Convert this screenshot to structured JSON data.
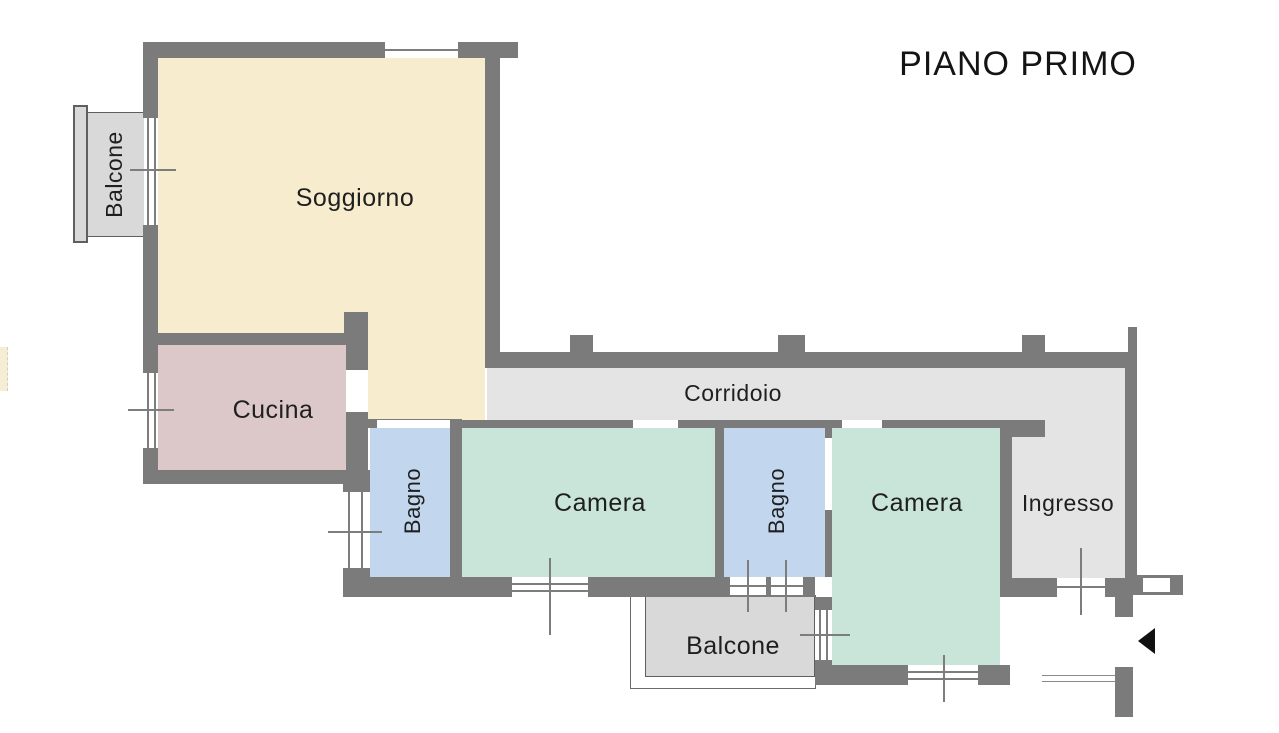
{
  "title": "PIANO PRIMO",
  "rooms": {
    "soggiorno": {
      "label": "Soggiorno"
    },
    "cucina": {
      "label": "Cucina"
    },
    "corridoio": {
      "label": "Corridoio"
    },
    "bagno1": {
      "label": "Bagno"
    },
    "camera1": {
      "label": "Camera"
    },
    "bagno2": {
      "label": "Bagno"
    },
    "camera2": {
      "label": "Camera"
    },
    "ingresso": {
      "label": "Ingresso"
    },
    "balcone_top_left": {
      "label": "Balcone"
    },
    "balcone_bottom": {
      "label": "Balcone"
    }
  },
  "colors": {
    "wall": "#7b7b7b",
    "soggiorno": "#f7ecce",
    "cucina": "#dcc8c8",
    "bagno": "#c2d7ee",
    "camera": "#c9e5d9",
    "corridoio": "#e4e4e4",
    "balcone": "#d9d9d9",
    "text": "#1f1f1f",
    "arrow": "#111111"
  },
  "icons": {
    "entrance_arrow": "filled-left-triangle"
  }
}
